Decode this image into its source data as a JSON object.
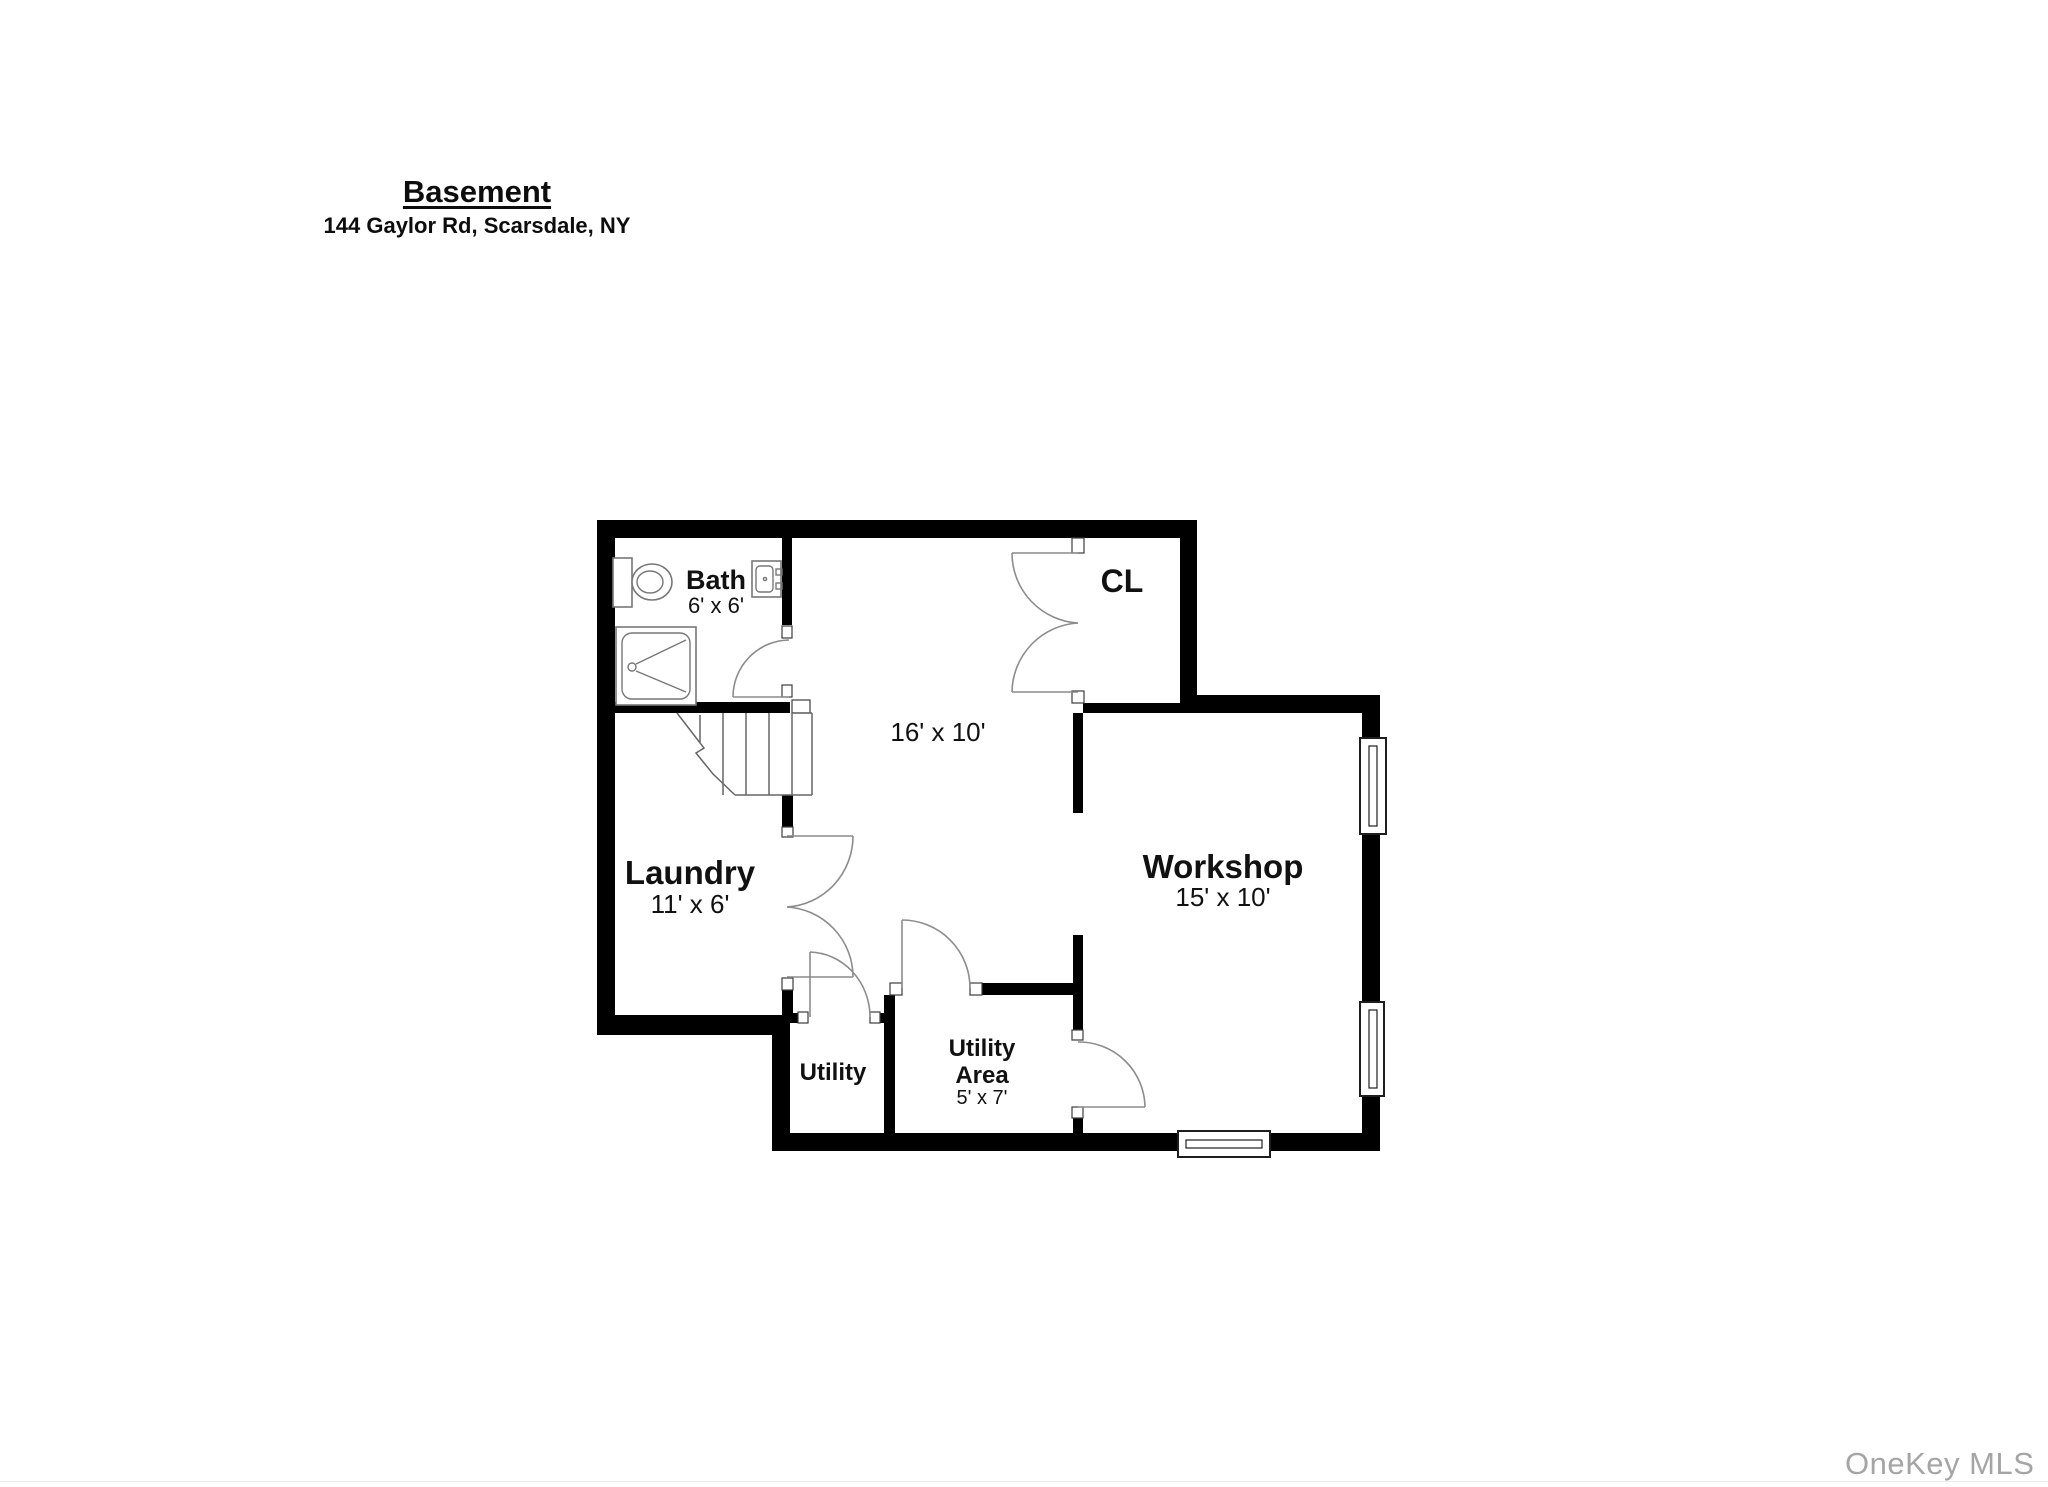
{
  "header": {
    "title": "Basement",
    "address": "144 Gaylor Rd, Scarsdale, NY"
  },
  "watermark": "OneKey MLS",
  "rooms": {
    "bath": {
      "label": "Bath",
      "dims": "6' x 6'"
    },
    "closet": {
      "label": "CL"
    },
    "main_room": {
      "dims": "16' x 10'"
    },
    "laundry": {
      "label": "Laundry",
      "dims": "11' x 6'"
    },
    "workshop": {
      "label": "Workshop",
      "dims": "15' x 10'"
    },
    "utility": {
      "label": "Utility"
    },
    "utility_area": {
      "label_line1": "Utility",
      "label_line2": "Area",
      "dims": "5' x 7'"
    }
  },
  "colors": {
    "wall": "#000000",
    "door_arc": "#8c8c8c",
    "fixture_line": "#777777",
    "window_frame": "#1e1e1e",
    "label_text": "#111111",
    "watermark_text": "#a5a5a5",
    "background": "#ffffff"
  }
}
